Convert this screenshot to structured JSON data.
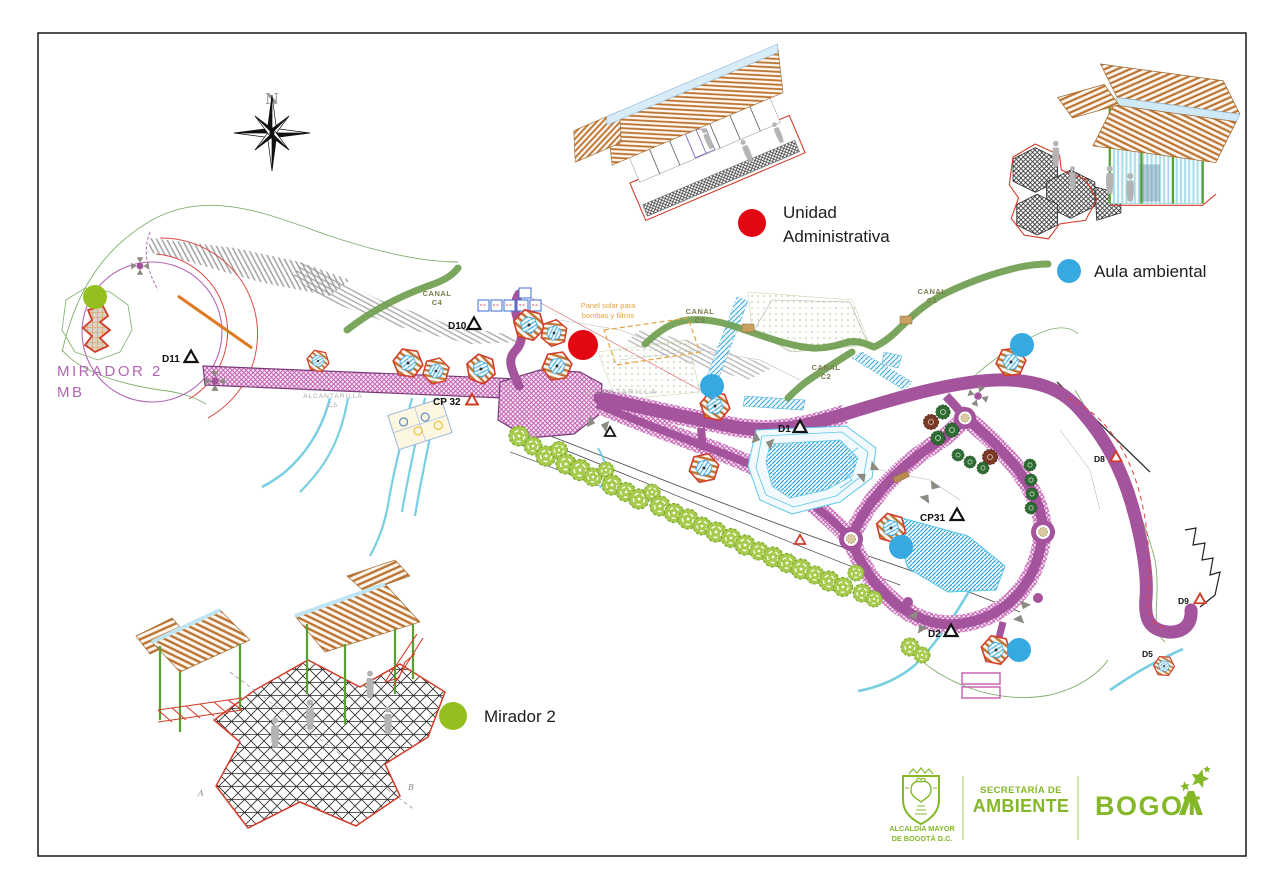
{
  "compass": {
    "north": "N"
  },
  "legend": {
    "unidad_line1": "Unidad",
    "unidad_line2": "Administrativa",
    "aula": "Aula ambiental",
    "mirador": "Mirador 2"
  },
  "plan": {
    "mirador_mb_line1": "MIRADOR 2",
    "mirador_mb_line2": "MB",
    "canal_c4_l1": "CANAL",
    "canal_c4_l2": "C4",
    "canal_c3_l1": "CANAL",
    "canal_c3_l2": "C3",
    "canal_c2_l1": "CANAL",
    "canal_c2_l2": "C2",
    "canal_c1_l1": "CANAL",
    "canal_c1_l2": "C1",
    "alcantarilla": "ALCANTARILLA",
    "alcantarilla_c5_l1": "ALCANTARILLA",
    "alcantarilla_c5_l2": "C5",
    "panel_solar_l1": "Panel solar para",
    "panel_solar_l2": "bombas y filtros",
    "marker_d10": "D10",
    "marker_d11": "D11",
    "marker_d1": "D1",
    "marker_d2": "D2",
    "marker_d5": "D5",
    "marker_d8": "D8",
    "marker_d9": "D9",
    "marker_cp32": "CP 32",
    "marker_cp31": "CP31",
    "section_a": "A",
    "section_b": "B"
  },
  "footer": {
    "alcaldia_l1": "ALCALDÍA MAYOR",
    "alcaldia_l2": "DE BOGOTÁ D.C.",
    "secretaria_l1": "SECRETARÍA DE",
    "secretaria_l2": "AMBIENTE",
    "bogota": "BOGOT"
  },
  "colors": {
    "legend_red": "#e30613",
    "legend_blue": "#36a9e1",
    "legend_green": "#93c01f",
    "brand_green": "#84b829",
    "path_purple": "#a4549c",
    "path_hatch_pink": "#c35ab1",
    "canal_green": "#6f9e50",
    "pond_blue": "#3da8dc",
    "stream_cyan": "#79cfe2",
    "roof_orange": "#bd7331",
    "mirador_text_purple": "#b565b5"
  }
}
